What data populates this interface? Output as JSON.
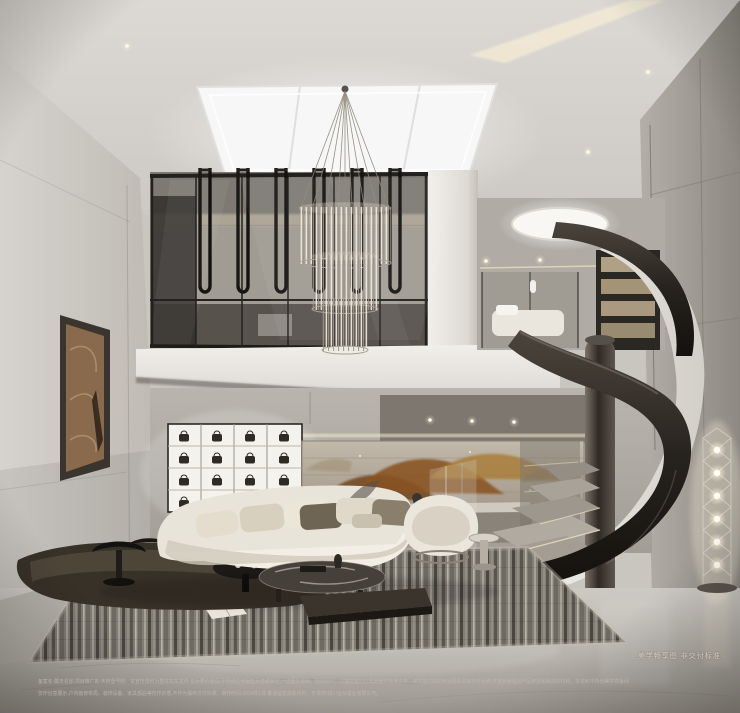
{
  "overlay": {
    "caption": "· 美学畅享图 非交付标准 ·",
    "disclaimer_line1": "备案名:麓天名邸,项目推广名:天府壹号院。本宣传资料为整体形象宣传,仅为要约邀请,不构成任何销售承诺或保证,一切图文资料、规划设计、公建配套均以政府最终批准文件、双方签订的买卖合同及实际交付为准,开发商保留对产品修改和改进的权利。本资料中所示美学样板间",
    "disclaimer_line2": "仅作创意展示,户内装修布局、装饰设备、家具部品等仅作示意,不作为最终交付标准。制作时间:2024年1月,敬请留意最新资料。开发商:四川合灿置业有限公司。"
  },
  "colors": {
    "ceiling_grey": "#d8d5d1",
    "wall_grey": "#c8c4be",
    "warm_light": "#f2e7cd",
    "dark_steel": "#211e1a",
    "mural_rust": "#8a5a28",
    "sofa_cream": "#eae5da",
    "floor_stone": "#bcb8b1",
    "caption_text": "#d8d1c3",
    "disclaimer_text": "#bfb9ad"
  }
}
